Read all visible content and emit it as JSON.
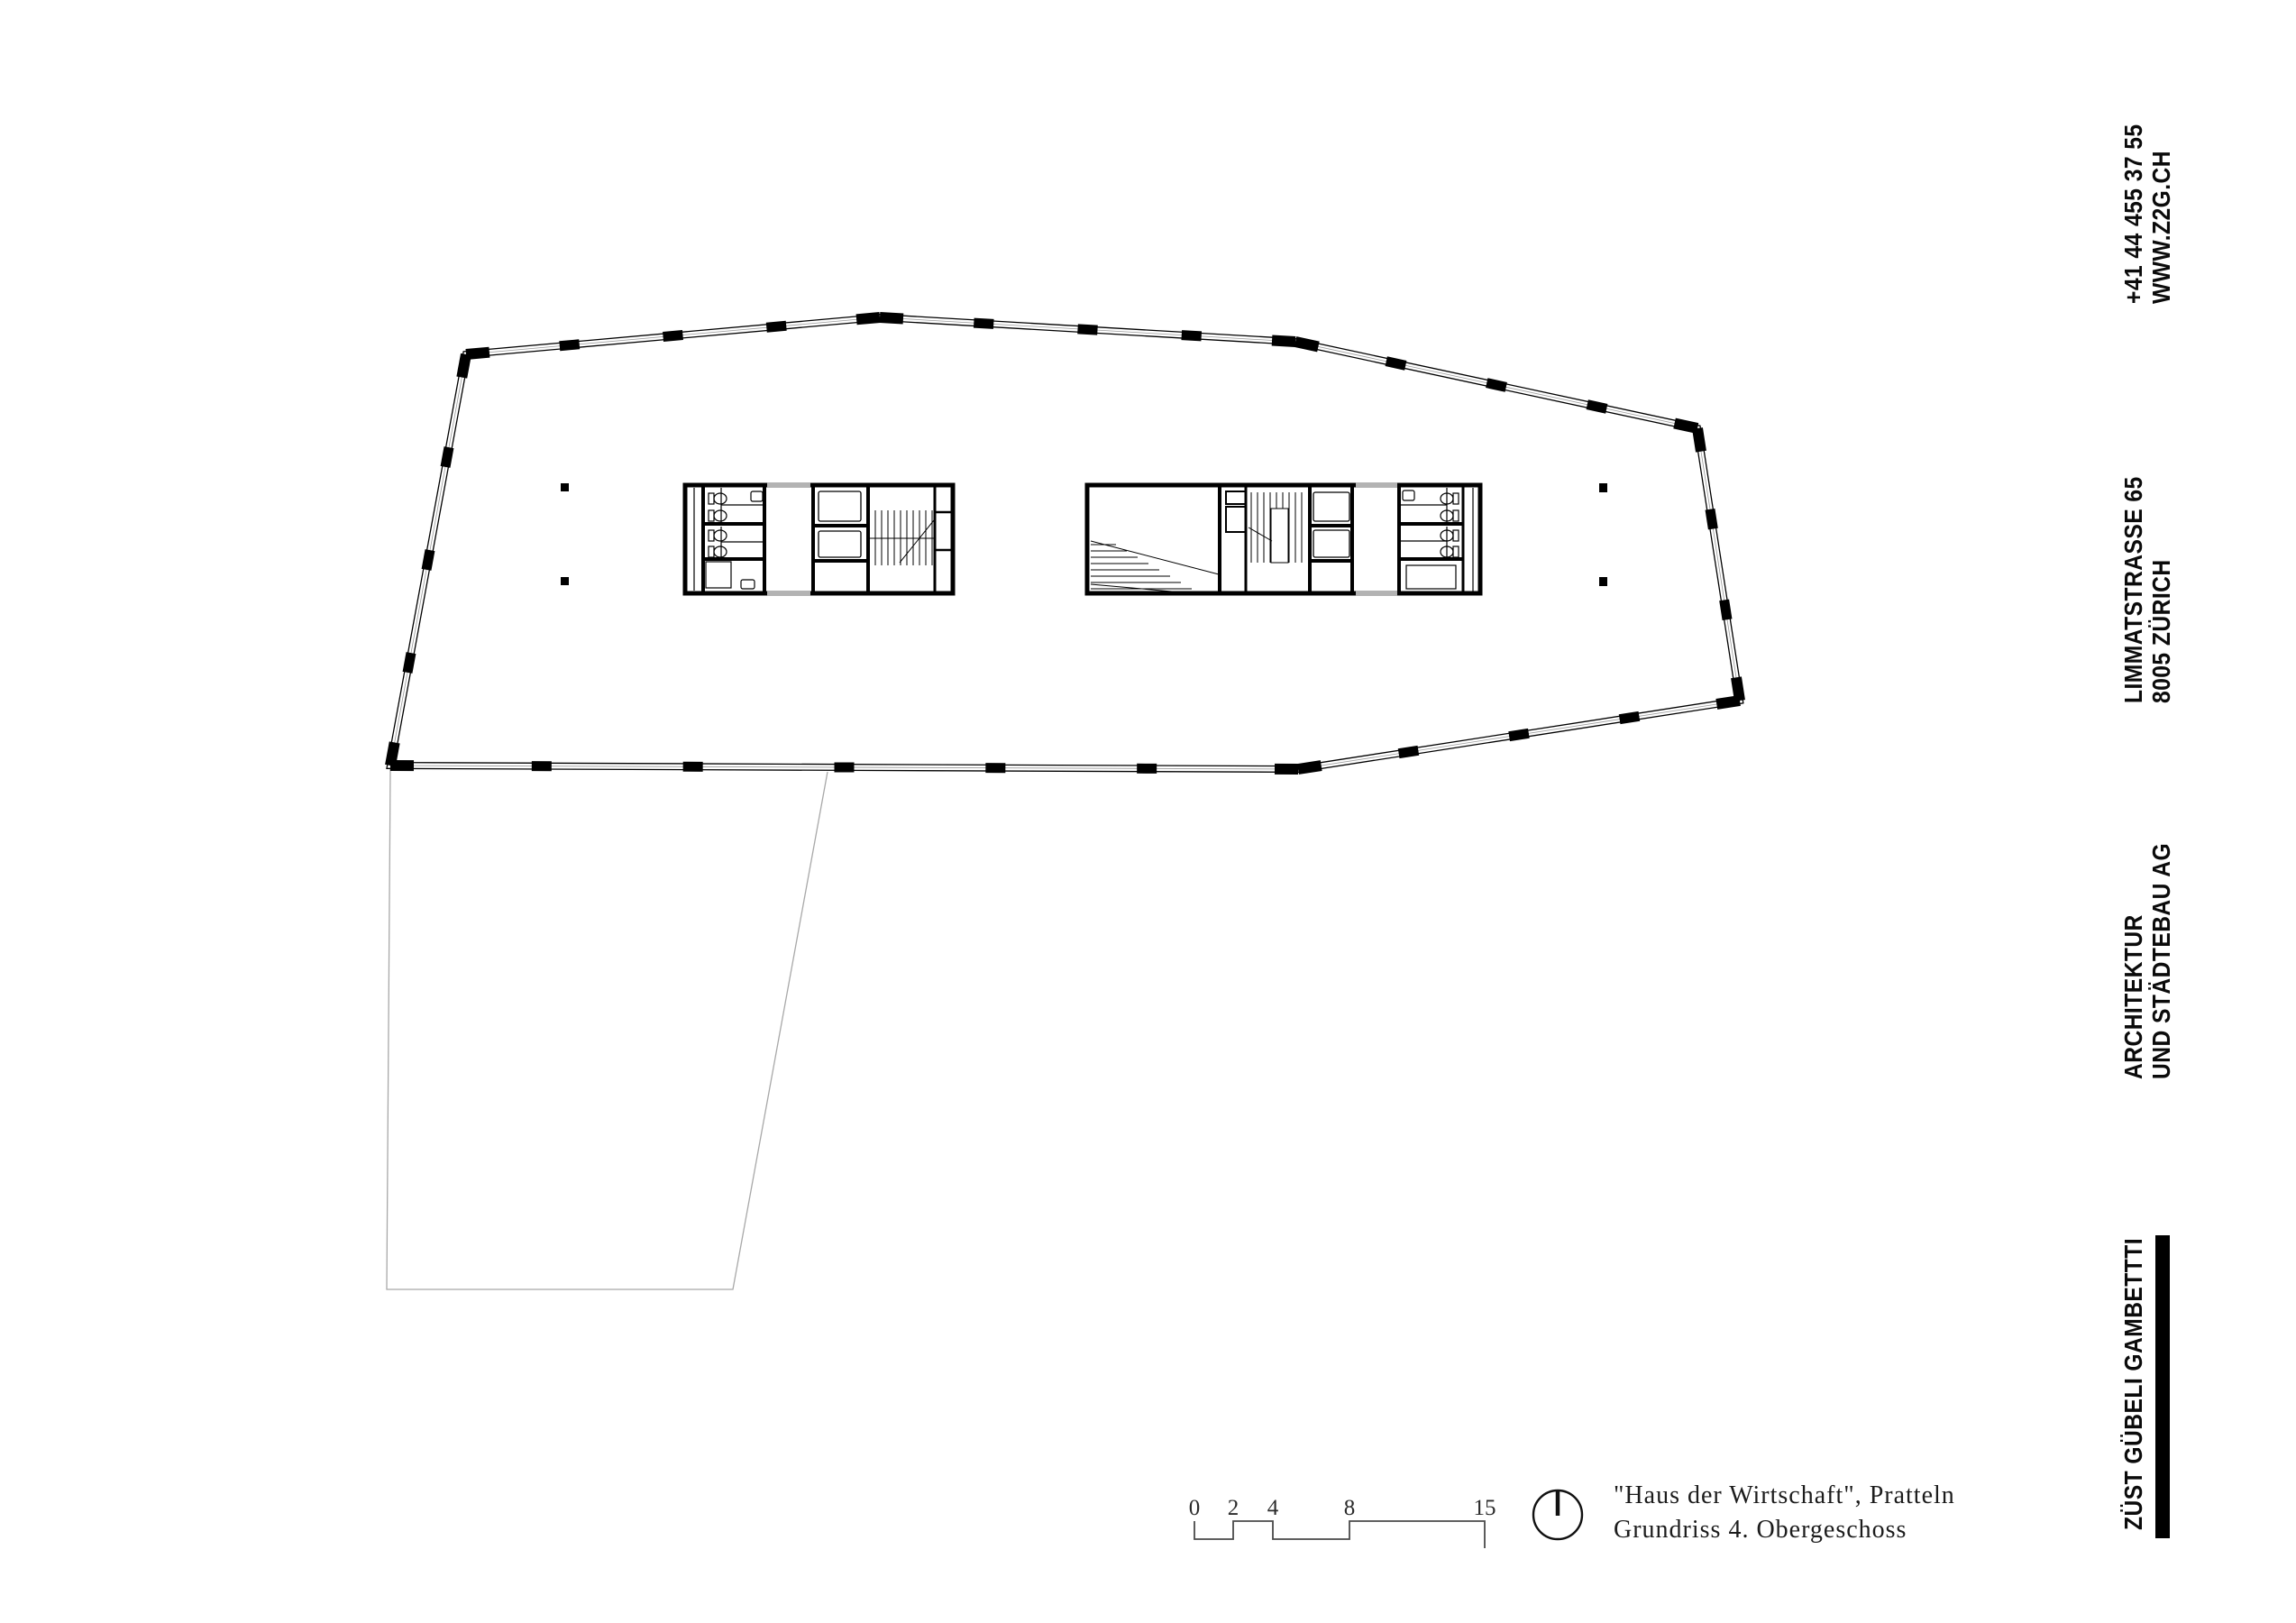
{
  "sidebar": {
    "contact": {
      "phone": "+41 44 455 37 55",
      "website": "WWW.Z2G.CH"
    },
    "address": {
      "street": "LIMMATSTRASSE 65",
      "city": "8005 ZÜRICH"
    },
    "firm": {
      "line1": "ARCHITEKTUR",
      "line2": "UND STÄDTEBAU AG"
    },
    "brand": {
      "name": "ZÜST GÜBELI GAMBETTTI"
    }
  },
  "titleblock": {
    "project": "\"Haus der Wirtschaft\", Pratteln",
    "drawing": "Grundriss 4. Obergeschoss"
  },
  "scalebar": {
    "labels": [
      "0",
      "2",
      "4",
      "8",
      "15"
    ]
  },
  "colors": {
    "ink": "#000000",
    "glass_line": "#999999",
    "threshold": "#b3b3b3",
    "site_line": "#a8a8a8",
    "scale_line": "#4a4a4a"
  }
}
